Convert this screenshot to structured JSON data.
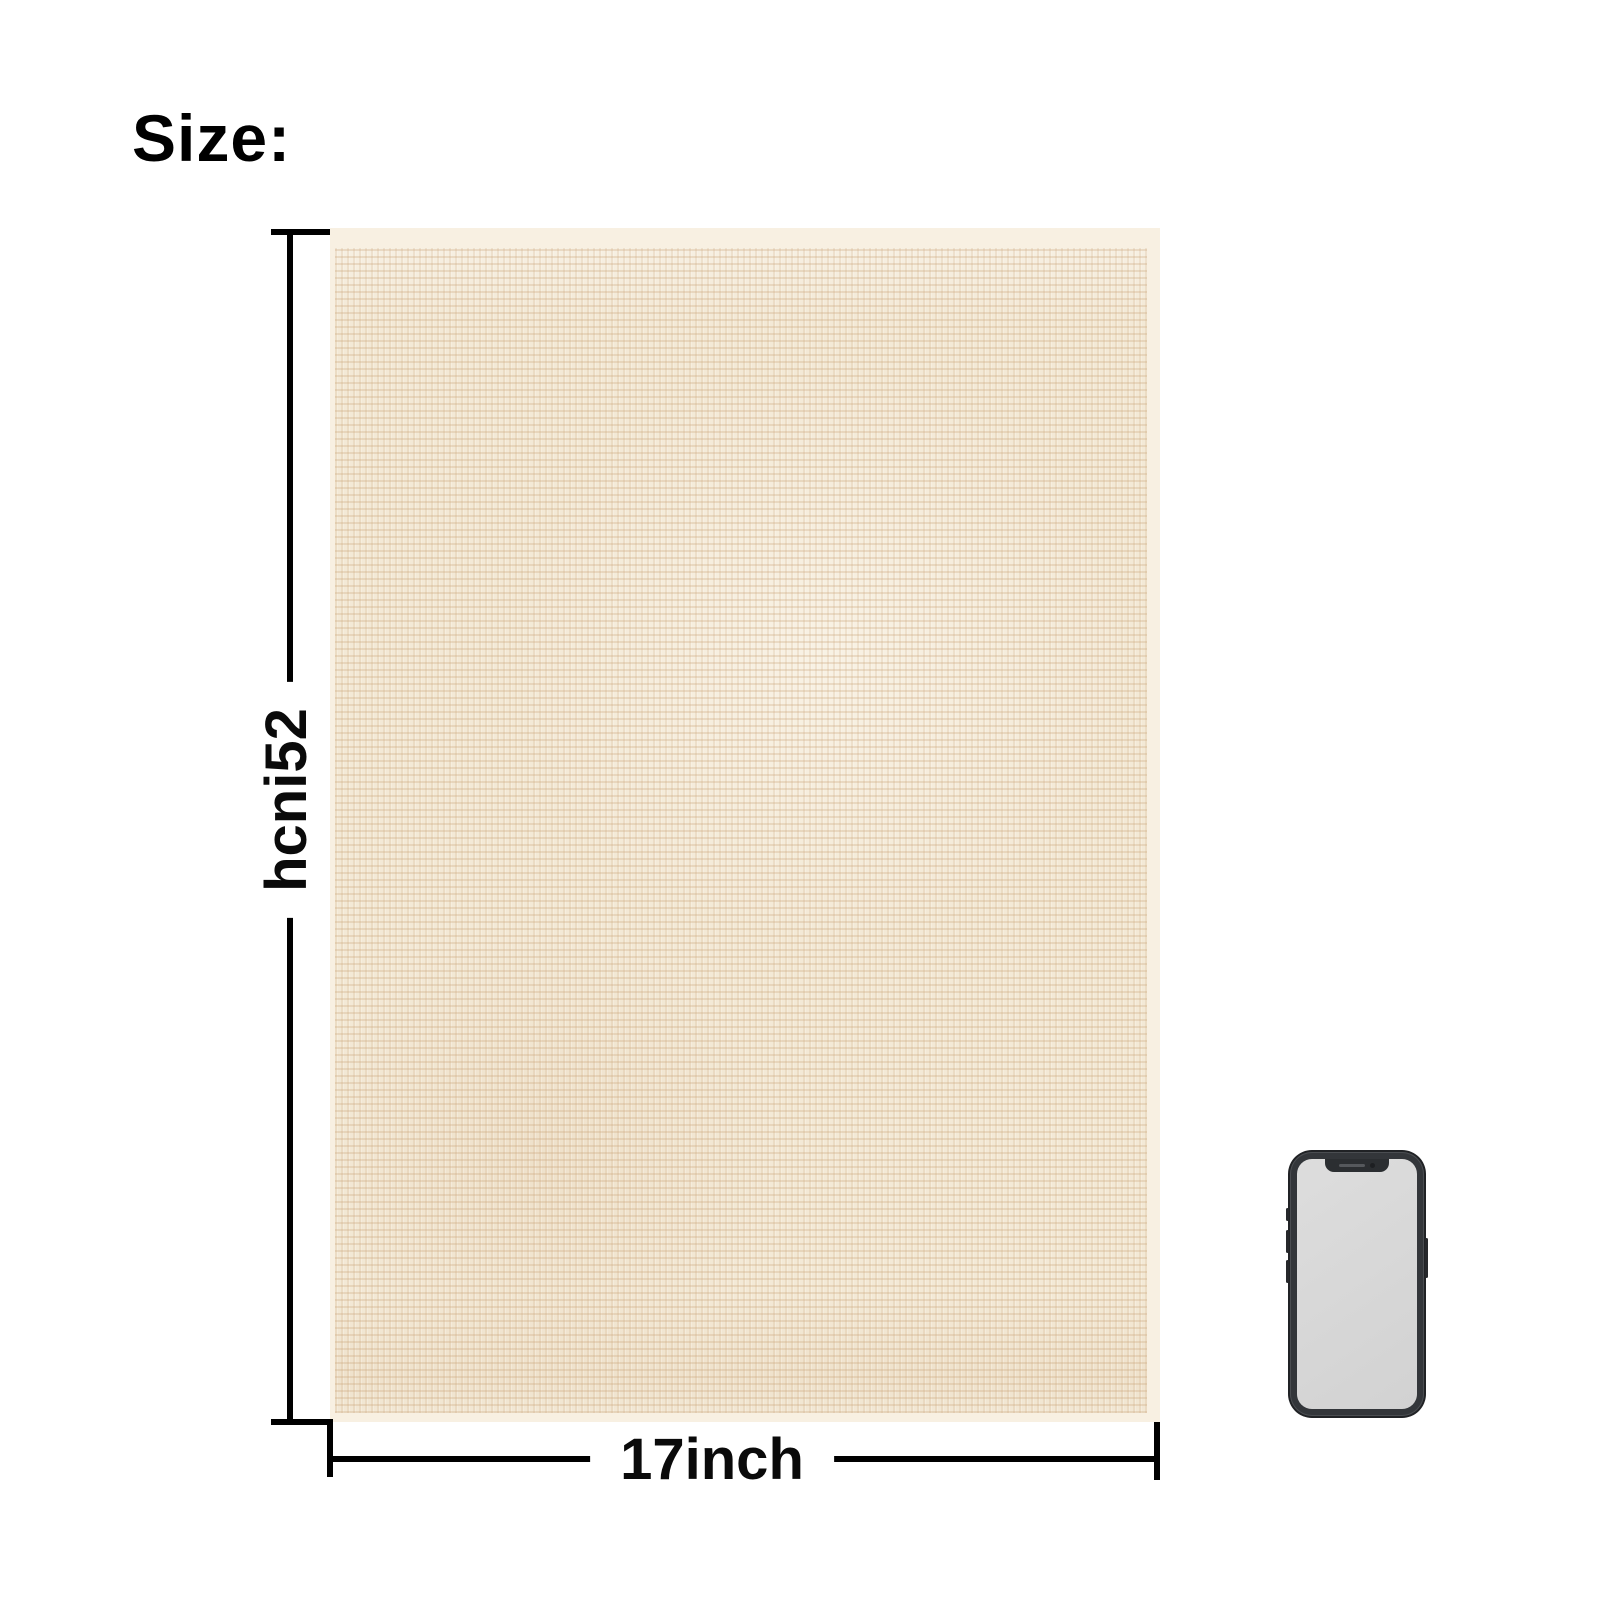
{
  "title": {
    "label": "Size:"
  },
  "dimensions": {
    "height": {
      "label": "25inch"
    },
    "width": {
      "label": "17inch"
    }
  },
  "towel": {
    "base_color": "#f3e9d6",
    "weave_color": "#cba67c",
    "hem_color": "#f8f0e2"
  },
  "phone": {
    "frame_color": "#33363a",
    "screen_color": "#d7d7d7"
  },
  "style": {
    "background_color": "#ffffff",
    "line_color": "#000000",
    "text_color": "#000000"
  }
}
